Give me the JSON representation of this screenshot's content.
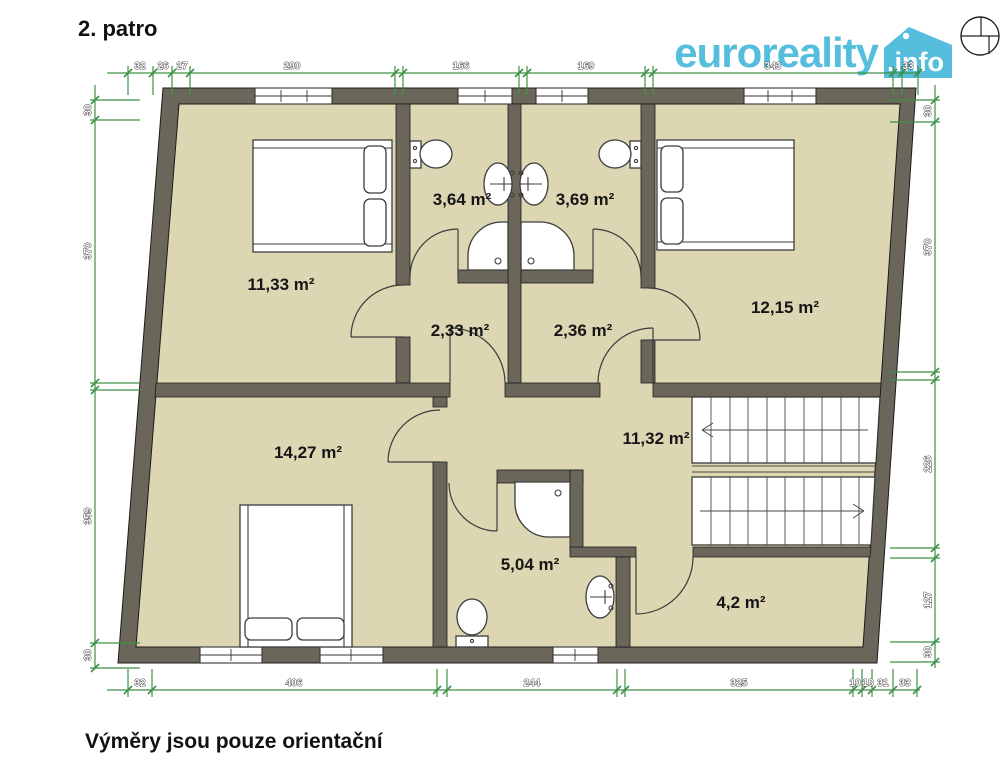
{
  "title": "2. patro",
  "footer_note": "Výměry jsou pouze orientační",
  "logo": {
    "brand": "euroreality",
    "suffix": ".info"
  },
  "rooms": [
    {
      "name": "bedroom-top-left",
      "area": "11,33 m²"
    },
    {
      "name": "bathroom-top-left",
      "area": "3,64 m²"
    },
    {
      "name": "bathroom-top-right",
      "area": "3,69 m²"
    },
    {
      "name": "bedroom-top-right",
      "area": "12,15 m²"
    },
    {
      "name": "hall-small-left",
      "area": "2,33 m²"
    },
    {
      "name": "hall-small-right",
      "area": "2,36 m²"
    },
    {
      "name": "bedroom-bottom-left",
      "area": "14,27 m²"
    },
    {
      "name": "hall-main",
      "area": "11,32 m²"
    },
    {
      "name": "bathroom-bottom",
      "area": "5,04 m²"
    },
    {
      "name": "room-bottom-right",
      "area": "4,2 m²"
    }
  ],
  "dimensions": {
    "top": [
      "32",
      "26",
      "27",
      "290",
      "166",
      "169",
      "343",
      "33"
    ],
    "bottom": [
      "32",
      "406",
      "244",
      "325",
      "10",
      "18",
      "31",
      "33"
    ],
    "left": [
      "30",
      "370",
      "359",
      "30"
    ],
    "right": [
      "30",
      "370",
      "226",
      "127",
      "30"
    ]
  },
  "colors": {
    "wall": "#6b665a",
    "floor": "#ddd6b2",
    "dimension_green": "#3e9144",
    "logo_blue": "#56bedd"
  }
}
